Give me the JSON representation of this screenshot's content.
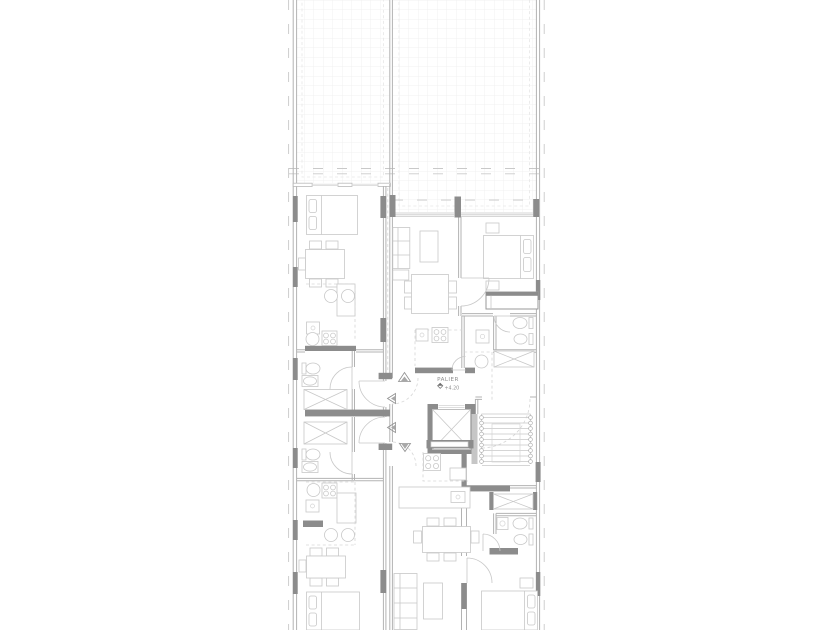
{
  "document": {
    "type": "architectural floor plan",
    "description": "typical apartment floor plan strip with upper terraces and a central core (landing, elevator, staircase)"
  },
  "landing": {
    "label": "PALIER",
    "level": "+4.20"
  },
  "colors": {
    "background": "#ffffff",
    "wall_line": "#b3b3b3",
    "heavy_line": "#9a9a9a",
    "furniture_line": "#c8c8c8",
    "structure_fill": "#8c8c8c",
    "tile_grid": "#ededed",
    "dashed_line": "#d6d6d6",
    "label_text": "#8f8f8f"
  },
  "areas": [
    {
      "name": "terrace-left"
    },
    {
      "name": "terrace-right"
    },
    {
      "name": "apartment-upper-left"
    },
    {
      "name": "apartment-upper-center"
    },
    {
      "name": "bedroom-upper-right"
    },
    {
      "name": "bathroom-mid-right"
    },
    {
      "name": "kitchen-mid-right"
    },
    {
      "name": "landing-core"
    },
    {
      "name": "elevator"
    },
    {
      "name": "staircase"
    },
    {
      "name": "apartment-lower-left"
    },
    {
      "name": "apartment-lower-center"
    },
    {
      "name": "bedroom-lower-right"
    },
    {
      "name": "bathroom-lower-right"
    }
  ],
  "symbols": [
    "double-bed",
    "pillow",
    "dining-table",
    "chair",
    "sofa",
    "coffee-table",
    "kitchen-sink",
    "cooktop-four-burner",
    "washbasin",
    "toilet",
    "bidet",
    "wardrobe-crossed",
    "kitchen-island",
    "bar-stool",
    "elevator-crossed-cabin",
    "stair-treads-with-balusters",
    "door-swing-arc",
    "section-marker-triangle",
    "structural-column",
    "tile-paving-grid",
    "level-marker",
    "boundary-dashed-line"
  ]
}
